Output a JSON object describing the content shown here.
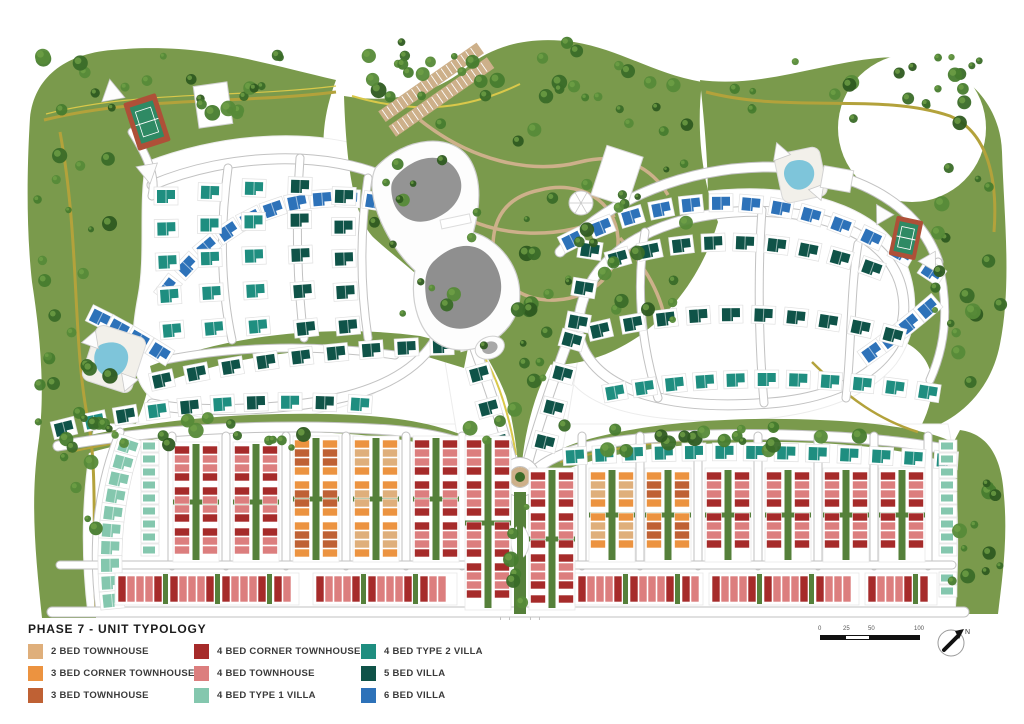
{
  "legend": {
    "title": "PHASE 7 - UNIT TYPOLOGY",
    "columns": [
      {
        "items": [
          {
            "key": "th2",
            "label": "2 BED TOWNHOUSE",
            "color": "#DFAF7B"
          },
          {
            "key": "th3c",
            "label": "3 BED CORNER TOWNHOUSE",
            "color": "#EC9340"
          },
          {
            "key": "th3",
            "label": "3 BED TOWNHOUSE",
            "color": "#BF6134"
          }
        ]
      },
      {
        "items": [
          {
            "key": "th4c",
            "label": "4 BED CORNER TOWNHOUSE",
            "color": "#A62B2A"
          },
          {
            "key": "th4",
            "label": "4 BED  TOWNHOUSE",
            "color": "#DC7E7E"
          },
          {
            "key": "v4t1",
            "label": "4 BED  TYPE 1 VILLA",
            "color": "#84C7AE"
          }
        ]
      },
      {
        "items": [
          {
            "key": "v4t2",
            "label": "4 BED  TYPE 2 VILLA",
            "color": "#1F8E80"
          },
          {
            "key": "v5",
            "label": "5 BED VILLA",
            "color": "#0F5348"
          },
          {
            "key": "v6",
            "label": "6 BED VILLA",
            "color": "#2D72B9"
          }
        ]
      }
    ]
  },
  "scale_bar": {
    "tick_labels": [
      "0",
      "25",
      "50",
      "100"
    ]
  },
  "compass": {
    "north_label": "N"
  },
  "palette": {
    "green_base": "#7A9A4C",
    "green_dark_strip": "#55803A",
    "tree_greens": [
      "#2E5A20",
      "#3A6B28",
      "#477C2E",
      "#568A38"
    ],
    "trail_olive": "#B3A23B",
    "trail_yellow": "#D9C84A",
    "road_fill": "#FFFFFF",
    "road_casing": "#C2C2C2",
    "plot_line": "#E0E0E0",
    "path_tan": "#CDB08A",
    "pool_blue": "#7EC5DA",
    "court_green": "#2F8A64",
    "court_red": "#AE5038",
    "roof_gray": "#949494"
  }
}
